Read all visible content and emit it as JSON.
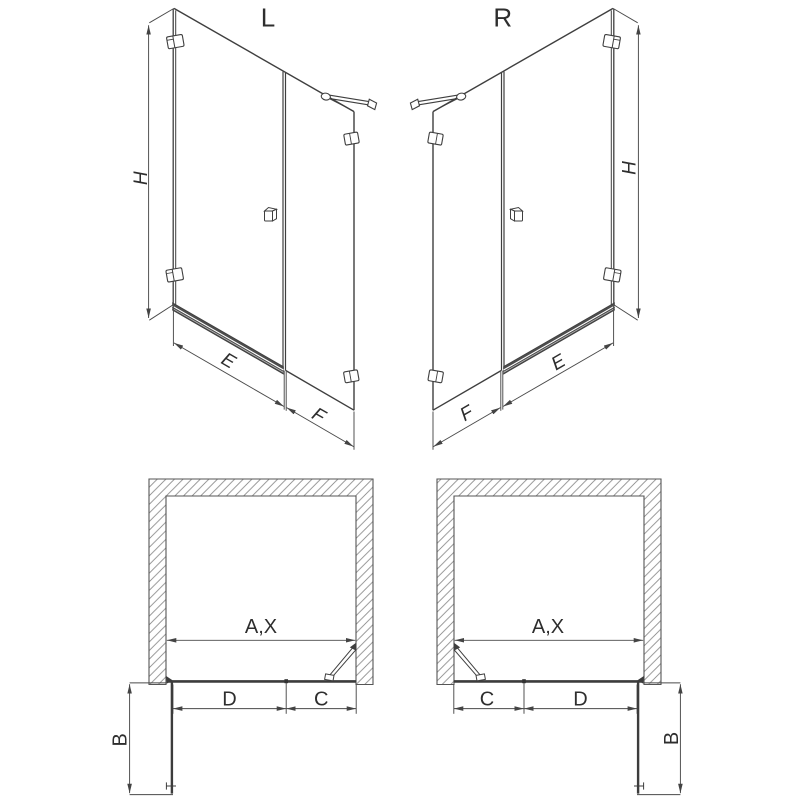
{
  "drawing": {
    "type": "shower-enclosure-technical-drawing",
    "colors": {
      "line": "#3f3f3f",
      "dimension": "#4a4a4a",
      "hatch": "#8c8c8c",
      "text": "#2e2e2e",
      "background": "#ffffff"
    }
  },
  "elevation_left": {
    "label": "L",
    "height": "H",
    "door_width": "E",
    "panel_width": "F"
  },
  "elevation_right": {
    "label": "R",
    "height": "H",
    "door_width": "E",
    "panel_width": "F"
  },
  "plan_left": {
    "opening": "A,X",
    "door": "D",
    "panel": "C",
    "clearance": "B"
  },
  "plan_right": {
    "opening": "A,X",
    "door": "D",
    "panel": "C",
    "clearance": "B"
  }
}
